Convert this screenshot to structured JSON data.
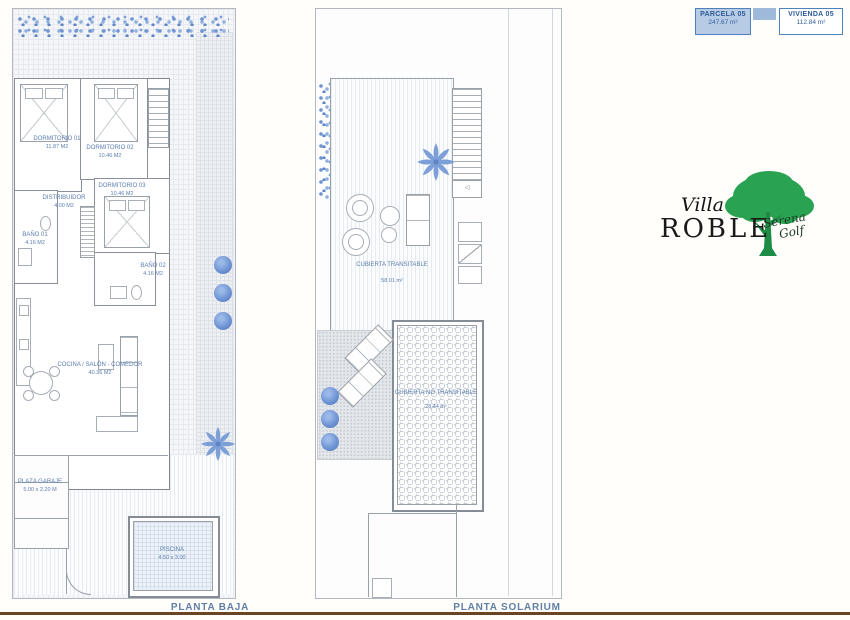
{
  "info_boxes": {
    "parcela": {
      "title": "PARCELA 05",
      "area": "247.67 m²"
    },
    "vivienda": {
      "title": "VIVIENDA 05",
      "area": "112.84 m²"
    }
  },
  "logo": {
    "villa": "Villa",
    "roble": "ROBLE",
    "script_line1": "Serena",
    "script_line2": "Golf"
  },
  "planta_baja": {
    "title": "PLANTA BAJA",
    "rooms": {
      "dormitorio1": {
        "name": "DORMITORIO 01",
        "area": "11.87 M2"
      },
      "dormitorio2": {
        "name": "DORMITORIO 02",
        "area": "10.46 M2"
      },
      "dormitorio3": {
        "name": "DORMITORIO 03",
        "area": "10.46 M2"
      },
      "distribuidor": {
        "name": "DISTRIBUIDOR",
        "area": "4.00 M2"
      },
      "bano1": {
        "name": "BAÑO 01",
        "area": "4.16 M2"
      },
      "bano2": {
        "name": "BAÑO 02",
        "area": "4.16 M2"
      },
      "salon": {
        "name": "COCINA / SALÓN - COMEDOR",
        "area": "40.36 M2"
      },
      "garaje": {
        "name": "PLAZA GARAJE",
        "area": "5.00 x 2.20 M"
      },
      "piscina": {
        "name": "PISCINA",
        "area": "4.50 x 3.00"
      }
    }
  },
  "planta_solarium": {
    "title": "PLANTA SOLARIUM",
    "areas": {
      "transitable": {
        "name": "CUBIERTA TRANSITABLE",
        "area": "58.01 m²"
      },
      "no_transitable": {
        "name": "CUBIERTA NO TRANSITABLE",
        "area": "28.44 m²"
      }
    }
  },
  "icons": {
    "stair_arrow": "◁"
  },
  "colors": {
    "accent_blue": "#4f81bd",
    "plan_text_blue": "#5b7db0",
    "vegetation_blue": "#6b91d2",
    "logo_green": "#27a04e",
    "bottom_bar_brown": "#6b4423"
  }
}
